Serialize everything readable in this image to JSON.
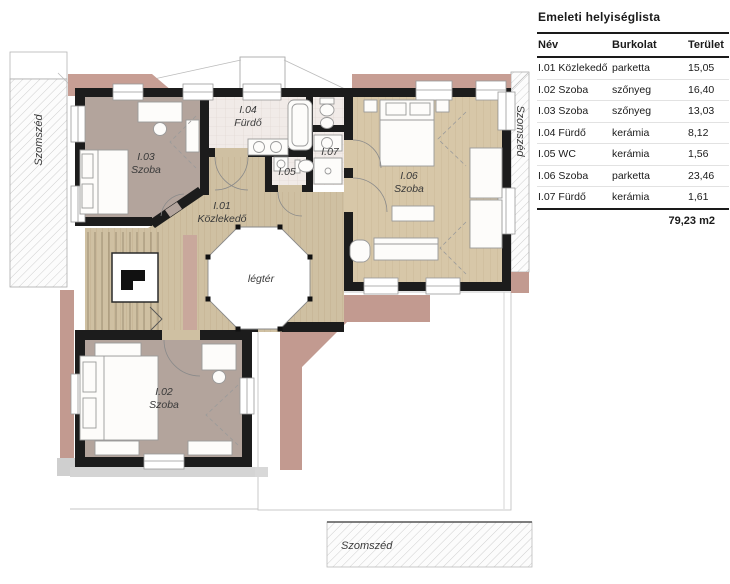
{
  "table": {
    "title": "Emeleti helyiséglista",
    "headers": {
      "name": "Név",
      "finish": "Burkolat",
      "area": "Terület"
    },
    "rows": [
      {
        "name": "I.01 Közlekedő",
        "finish": "parketta",
        "area": "15,05"
      },
      {
        "name": "I.02 Szoba",
        "finish": "szőnyeg",
        "area": "16,40"
      },
      {
        "name": "I.03 Szoba",
        "finish": "szőnyeg",
        "area": "13,03"
      },
      {
        "name": "I.04 Fürdő",
        "finish": "kerámia",
        "area": "8,12"
      },
      {
        "name": "I.05 WC",
        "finish": "kerámia",
        "area": "1,56"
      },
      {
        "name": "I.06 Szoba",
        "finish": "parketta",
        "area": "23,46"
      },
      {
        "name": "I.07 Fürdő",
        "finish": "kerámia",
        "area": "1,61"
      }
    ],
    "total": "79,23 m2"
  },
  "plan": {
    "labels": {
      "i01_id": "I.01",
      "i01_name": "Közlekedő",
      "i02_id": "I.02",
      "i02_name": "Szoba",
      "i03_id": "I.03",
      "i03_name": "Szoba",
      "i04_id": "I.04",
      "i04_name": "Fürdő",
      "i05_id": "I.05",
      "i06_id": "I.06",
      "i06_name": "Szoba",
      "i07_id": "I.07",
      "void": "légtér",
      "neighbor_left": "Szomszéd",
      "neighbor_right": "Szomszéd",
      "neighbor_bottom": "Szomszéd"
    },
    "colors": {
      "wall": "#1c1c1c",
      "room_taupe": "#b3a49c",
      "floor_tan": "#cfc0a2",
      "floor_wood": "#d7c7a8",
      "floor_tile": "#f1ebe8",
      "roof_pink": "#c29a90",
      "hatch_line": "#cfcfcf"
    }
  }
}
